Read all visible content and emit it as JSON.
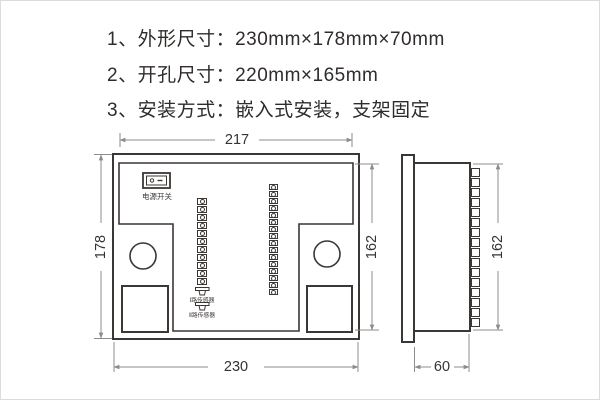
{
  "colors": {
    "line": "#3b3735",
    "dim_line": "#8c8c8c",
    "text": "#2f2c2b"
  },
  "specs": {
    "items": [
      {
        "prefix": "1、外形尺寸：",
        "value": "230mm×178mm×70mm"
      },
      {
        "prefix": "2、开孔尺寸：",
        "value": "220mm×165mm"
      },
      {
        "prefix": "3、安装方式：",
        "value": "嵌入式安装，支架固定"
      }
    ]
  },
  "back_view": {
    "power_switch_label": "电源开关",
    "sensor_labels": {
      "s1": "Ⅰ路传感器",
      "s2": "Ⅱ路传感器"
    },
    "dims": {
      "top": "217",
      "left": "178",
      "right": "162",
      "bottom": "230"
    },
    "left_terminals": 11,
    "right_terminals": 16
  },
  "side_view": {
    "dims": {
      "right": "162",
      "bottom": "60"
    },
    "terminals": 16
  }
}
